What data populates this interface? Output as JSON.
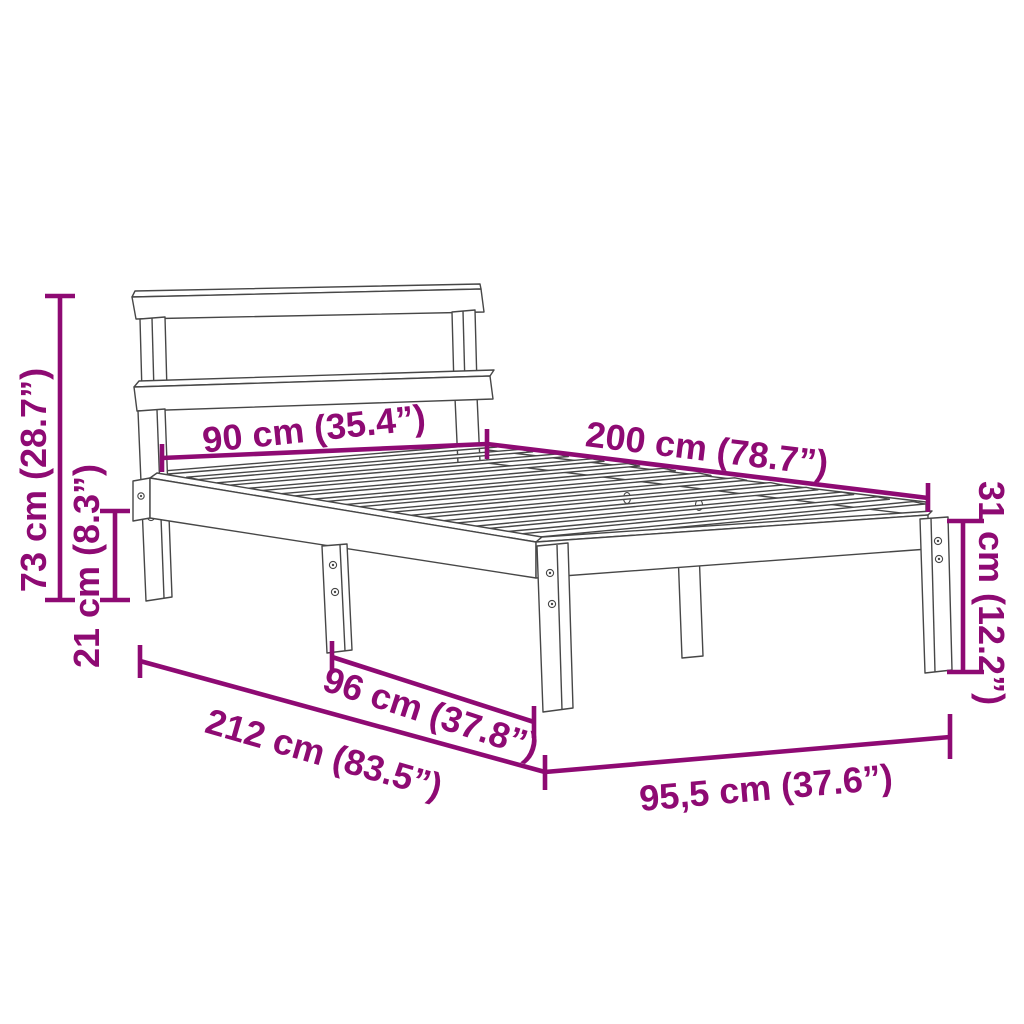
{
  "page": {
    "background": "#ffffff",
    "description": "Bed frame with headboard and slatted base - dimension diagram line drawing"
  },
  "colors": {
    "dimension": "#8e0a73",
    "drawing": "#474747",
    "background": "#ffffff"
  },
  "drawing": {
    "subject": "bed-frame-line-drawing",
    "slat_count": 13
  },
  "dimensions": {
    "overall_height": "73 cm (28.7”)",
    "under_bed_clearance": "21 cm (8.3”)",
    "headboard_width": "90 cm (35.4”)",
    "bed_length": "200 cm (78.7”)",
    "frame_height": "31 cm (12.2”)",
    "leg_spacing": "96 cm (37.8”)",
    "overall_length": "212 cm (83.5”)",
    "overall_width": "95,5 cm (37.6”)"
  }
}
